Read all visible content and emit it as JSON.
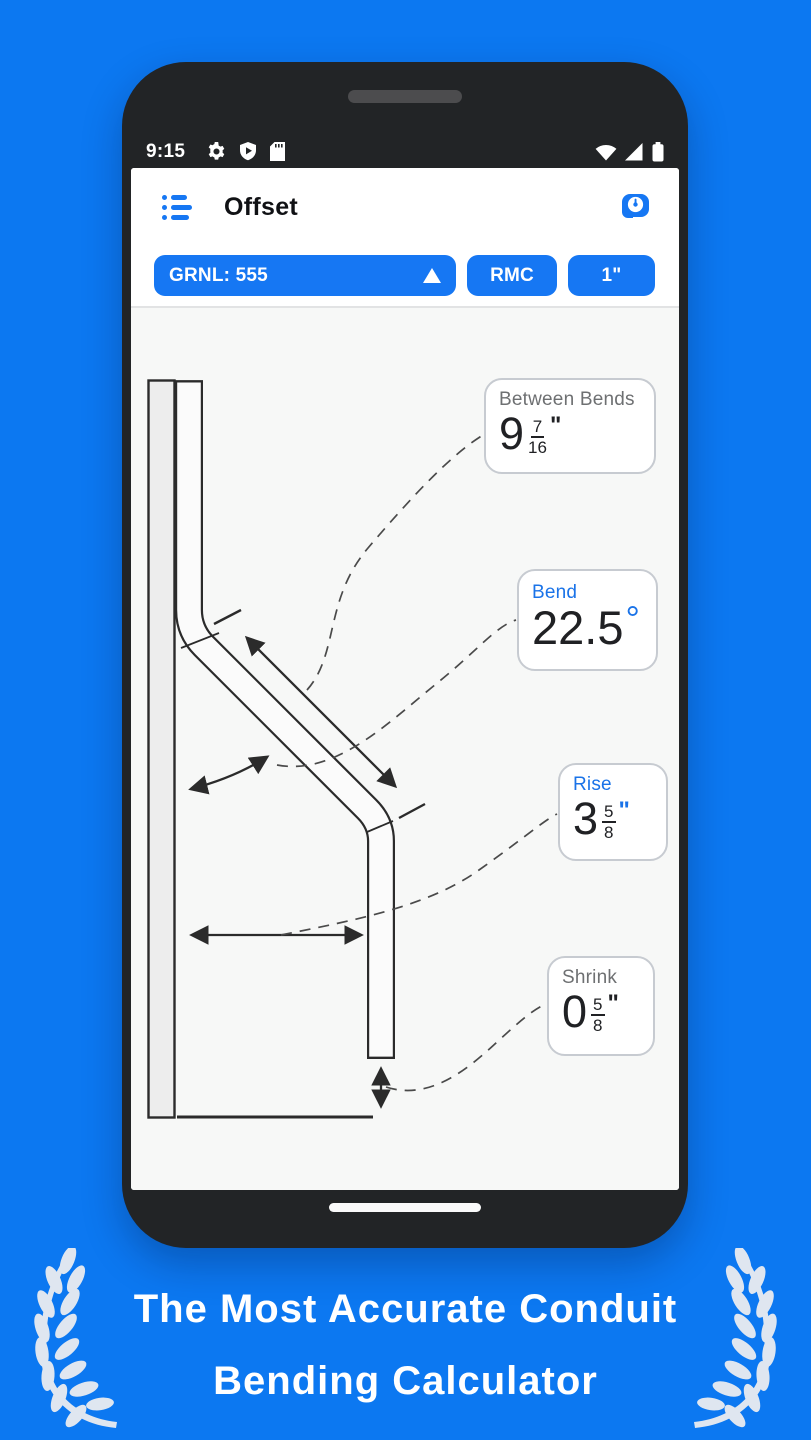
{
  "colors": {
    "background_blue": "#0c78f1",
    "accent_blue": "#1677f3",
    "label_blue": "#1a73e8",
    "ink": "#202124"
  },
  "status_bar": {
    "time": "9:15",
    "left_icons": [
      "gear-icon",
      "play-protect-shield-icon",
      "sd-card-icon"
    ],
    "right_icons": [
      "wifi-icon",
      "cell-signal-icon",
      "battery-icon"
    ]
  },
  "app_bar": {
    "title": "Offset",
    "menu_icon": "list-menu-icon",
    "tool_icon": "tape-measure-icon"
  },
  "controls": {
    "bender": {
      "label": "GRNL: 555",
      "icon": "triangle-up-icon"
    },
    "material": {
      "label": "RMC"
    },
    "size": {
      "label": "1\""
    }
  },
  "callouts": {
    "between_bends": {
      "label": "Between Bends",
      "whole": "9",
      "numerator": "7",
      "denominator": "16",
      "unit": "\""
    },
    "bend": {
      "label": "Bend",
      "value": "22.5",
      "unit": "°"
    },
    "rise": {
      "label": "Rise",
      "whole": "3",
      "numerator": "5",
      "denominator": "8",
      "unit": "\""
    },
    "shrink": {
      "label": "Shrink",
      "whole": "0",
      "numerator": "5",
      "denominator": "8",
      "unit": "\""
    }
  },
  "caption": {
    "line1": "The Most Accurate Conduit",
    "line2": "Bending Calculator"
  }
}
